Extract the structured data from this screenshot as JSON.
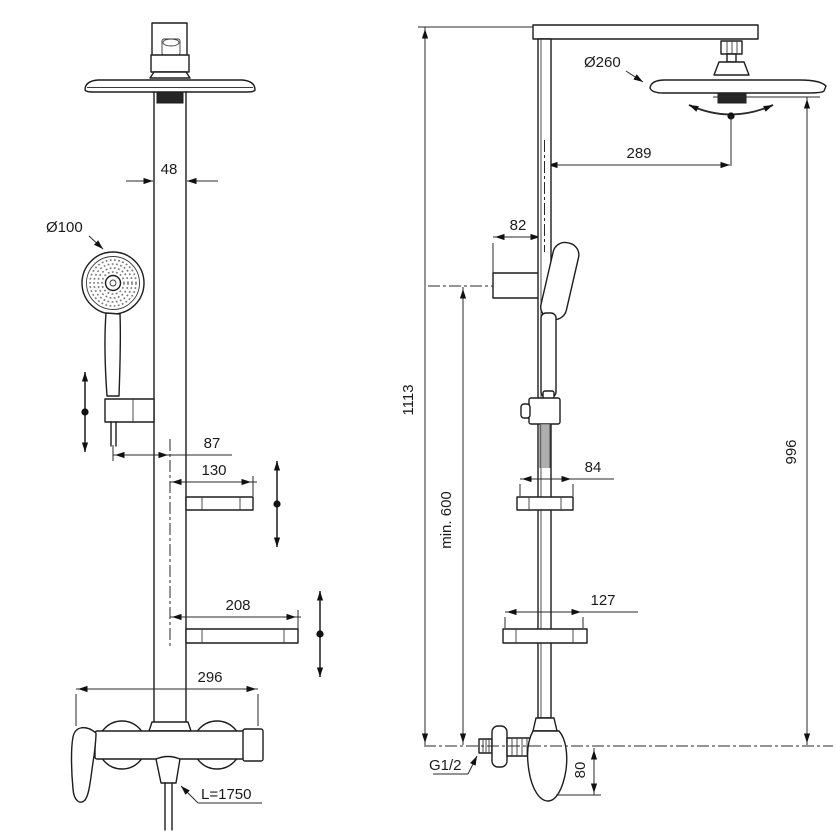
{
  "meta": {
    "title": "Shower column technical drawing",
    "views": [
      "front",
      "side"
    ]
  },
  "colors": {
    "line": "#1d1d1d",
    "dimension": "#2a2a2a",
    "dark_fill": "#262626",
    "background": "#ffffff"
  },
  "front": {
    "column_width": "48",
    "hand_shower_diameter": "Ø100",
    "holder_to_center": "87",
    "upper_shelf_width": "130",
    "lower_shelf_width": "208",
    "mixer_width": "296",
    "hose_length": "L=1750"
  },
  "side": {
    "head_diameter": "Ø260",
    "head_reach": "289",
    "holder_depth": "82",
    "total_height": "1113",
    "min_mounting_height": "min. 600",
    "upper_shelf_depth": "84",
    "head_underside_height": "996",
    "lower_shelf_depth": "127",
    "inlet_thread": "G1/2",
    "body_drop": "80"
  }
}
